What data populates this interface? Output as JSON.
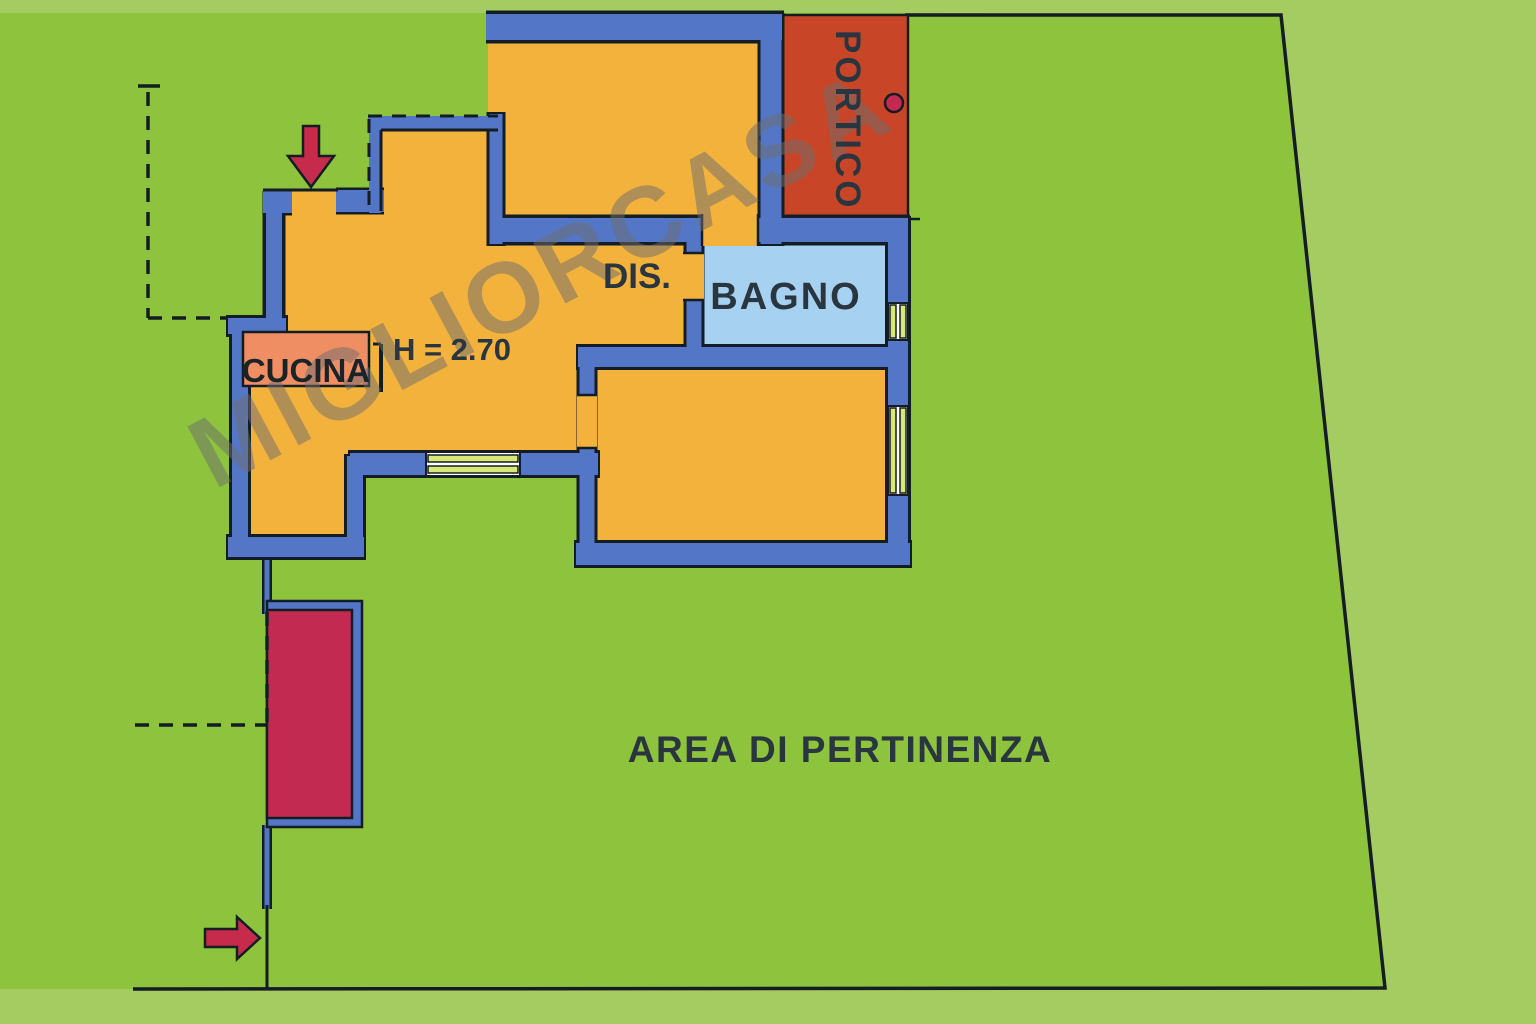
{
  "plan": {
    "rooms": {
      "portico": "PORTICO",
      "bagno": "BAGNO",
      "cucina": "CUCINA",
      "disimpegno": "DIS."
    },
    "height_label": "H = 2.70",
    "area_label": "AREA DI PERTINENZA",
    "watermark": "MIGLIORCASA",
    "icons": {
      "entrance_arrow_top": "down-arrow-icon",
      "entrance_arrow_bottom": "right-arrow-icon",
      "portico_dot": "column-dot-icon"
    }
  },
  "colors": {
    "green_outer": "#A4CC60",
    "green_inner": "#8DC33D",
    "wall_blue": "#5377C6",
    "floor_orange": "#F3B23C",
    "portico_red": "#C94527",
    "bagno_blue": "#A6D1F0",
    "counter_salmon": "#EF8E62",
    "crimson": "#C32A52",
    "window_yellow": "#D8E878",
    "line_black": "#141C24",
    "label_dark": "#2A363F",
    "label_black": "#1A222A",
    "watermark_gray": "#6E6E6E",
    "arrow_red": "#C62B4C"
  }
}
